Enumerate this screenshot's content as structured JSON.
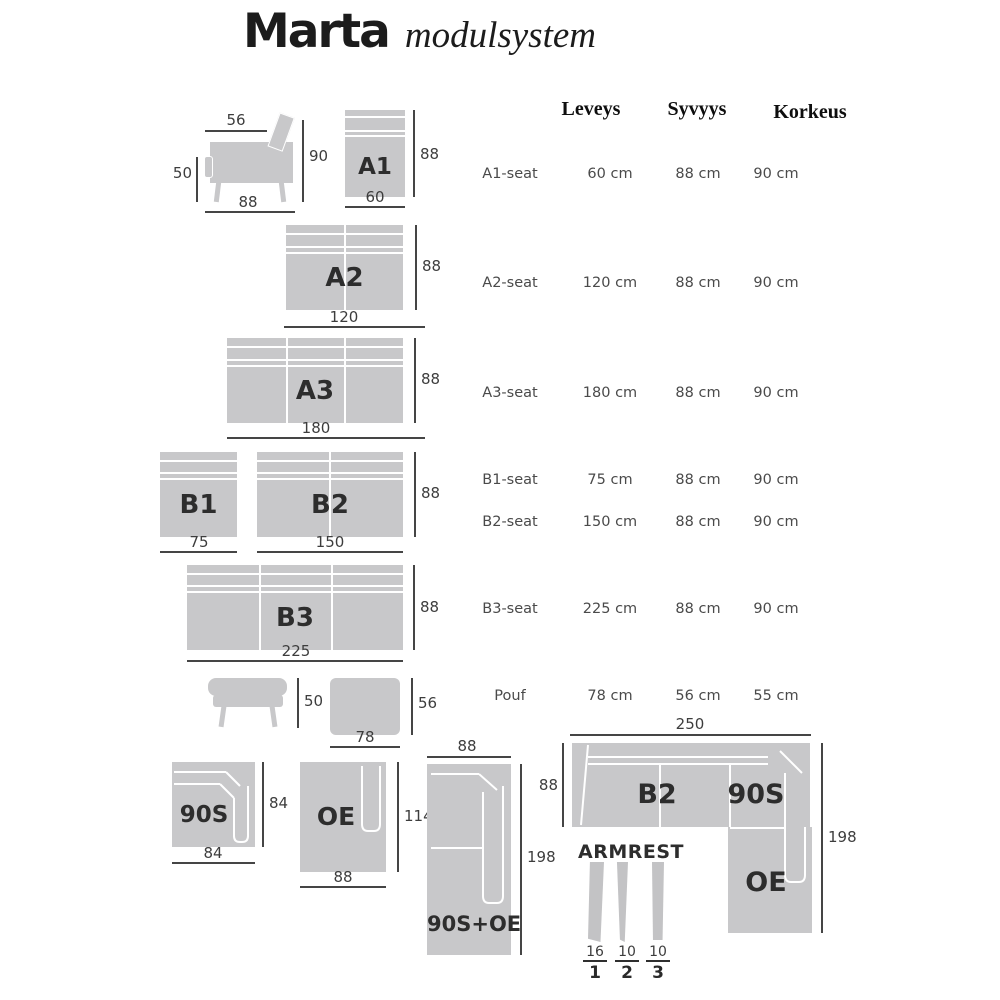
{
  "title": {
    "main": "Marta",
    "sub": "modulsystem"
  },
  "table": {
    "headers": [
      "Leveys",
      "Syvyys",
      "Korkeus"
    ],
    "rows": [
      {
        "label": "A1-seat",
        "w": "60 cm",
        "d": "88 cm",
        "h": "90 cm"
      },
      {
        "label": "A2-seat",
        "w": "120 cm",
        "d": "88 cm",
        "h": "90 cm"
      },
      {
        "label": "A3-seat",
        "w": "180 cm",
        "d": "88 cm",
        "h": "90 cm"
      },
      {
        "label": "B1-seat",
        "w": "75 cm",
        "d": "88 cm",
        "h": "90 cm"
      },
      {
        "label": "B2-seat",
        "w": "150 cm",
        "d": "88 cm",
        "h": "90 cm"
      },
      {
        "label": "B3-seat",
        "w": "225 cm",
        "d": "88 cm",
        "h": "90 cm"
      },
      {
        "label": "Pouf",
        "w": "78 cm",
        "d": "56 cm",
        "h": "55 cm"
      }
    ]
  },
  "diagrams": {
    "armchair_side": {
      "top": "56",
      "left": "50",
      "right": "90",
      "bottom": "88"
    },
    "a1": {
      "label": "A1",
      "right": "88",
      "bottom": "60"
    },
    "a2": {
      "label": "A2",
      "right": "88",
      "bottom": "120"
    },
    "a3": {
      "label": "A3",
      "right": "88",
      "bottom": "180"
    },
    "b1": {
      "label": "B1",
      "bottom": "75"
    },
    "b2": {
      "label": "B2",
      "right": "88",
      "bottom": "150"
    },
    "b3": {
      "label": "B3",
      "right": "88",
      "bottom": "225"
    },
    "pouf_side": {
      "right": "50"
    },
    "pouf_top": {
      "right": "56",
      "bottom": "78"
    },
    "corner_90s": {
      "label": "90S",
      "right": "84",
      "bottom": "84"
    },
    "open_end": {
      "label": "OE",
      "right": "114",
      "bottom": "88"
    },
    "combo_90s_oe": {
      "label": "90S+OE",
      "top": "88",
      "right": "198"
    },
    "corner_sofa": {
      "top": "250",
      "left": "88",
      "right": "198",
      "seat_label": "B2",
      "corner_label": "90S",
      "end_label": "OE"
    },
    "armrests": {
      "title": "ARMREST",
      "items": [
        {
          "size": "16",
          "num": "1"
        },
        {
          "size": "10",
          "num": "2"
        },
        {
          "size": "10",
          "num": "3"
        }
      ]
    }
  },
  "colors": {
    "module_fill": "#c8c8ca",
    "dim_line": "#454545",
    "label_dark": "#2d2d2d",
    "table_gray": "#4a4a4a"
  }
}
